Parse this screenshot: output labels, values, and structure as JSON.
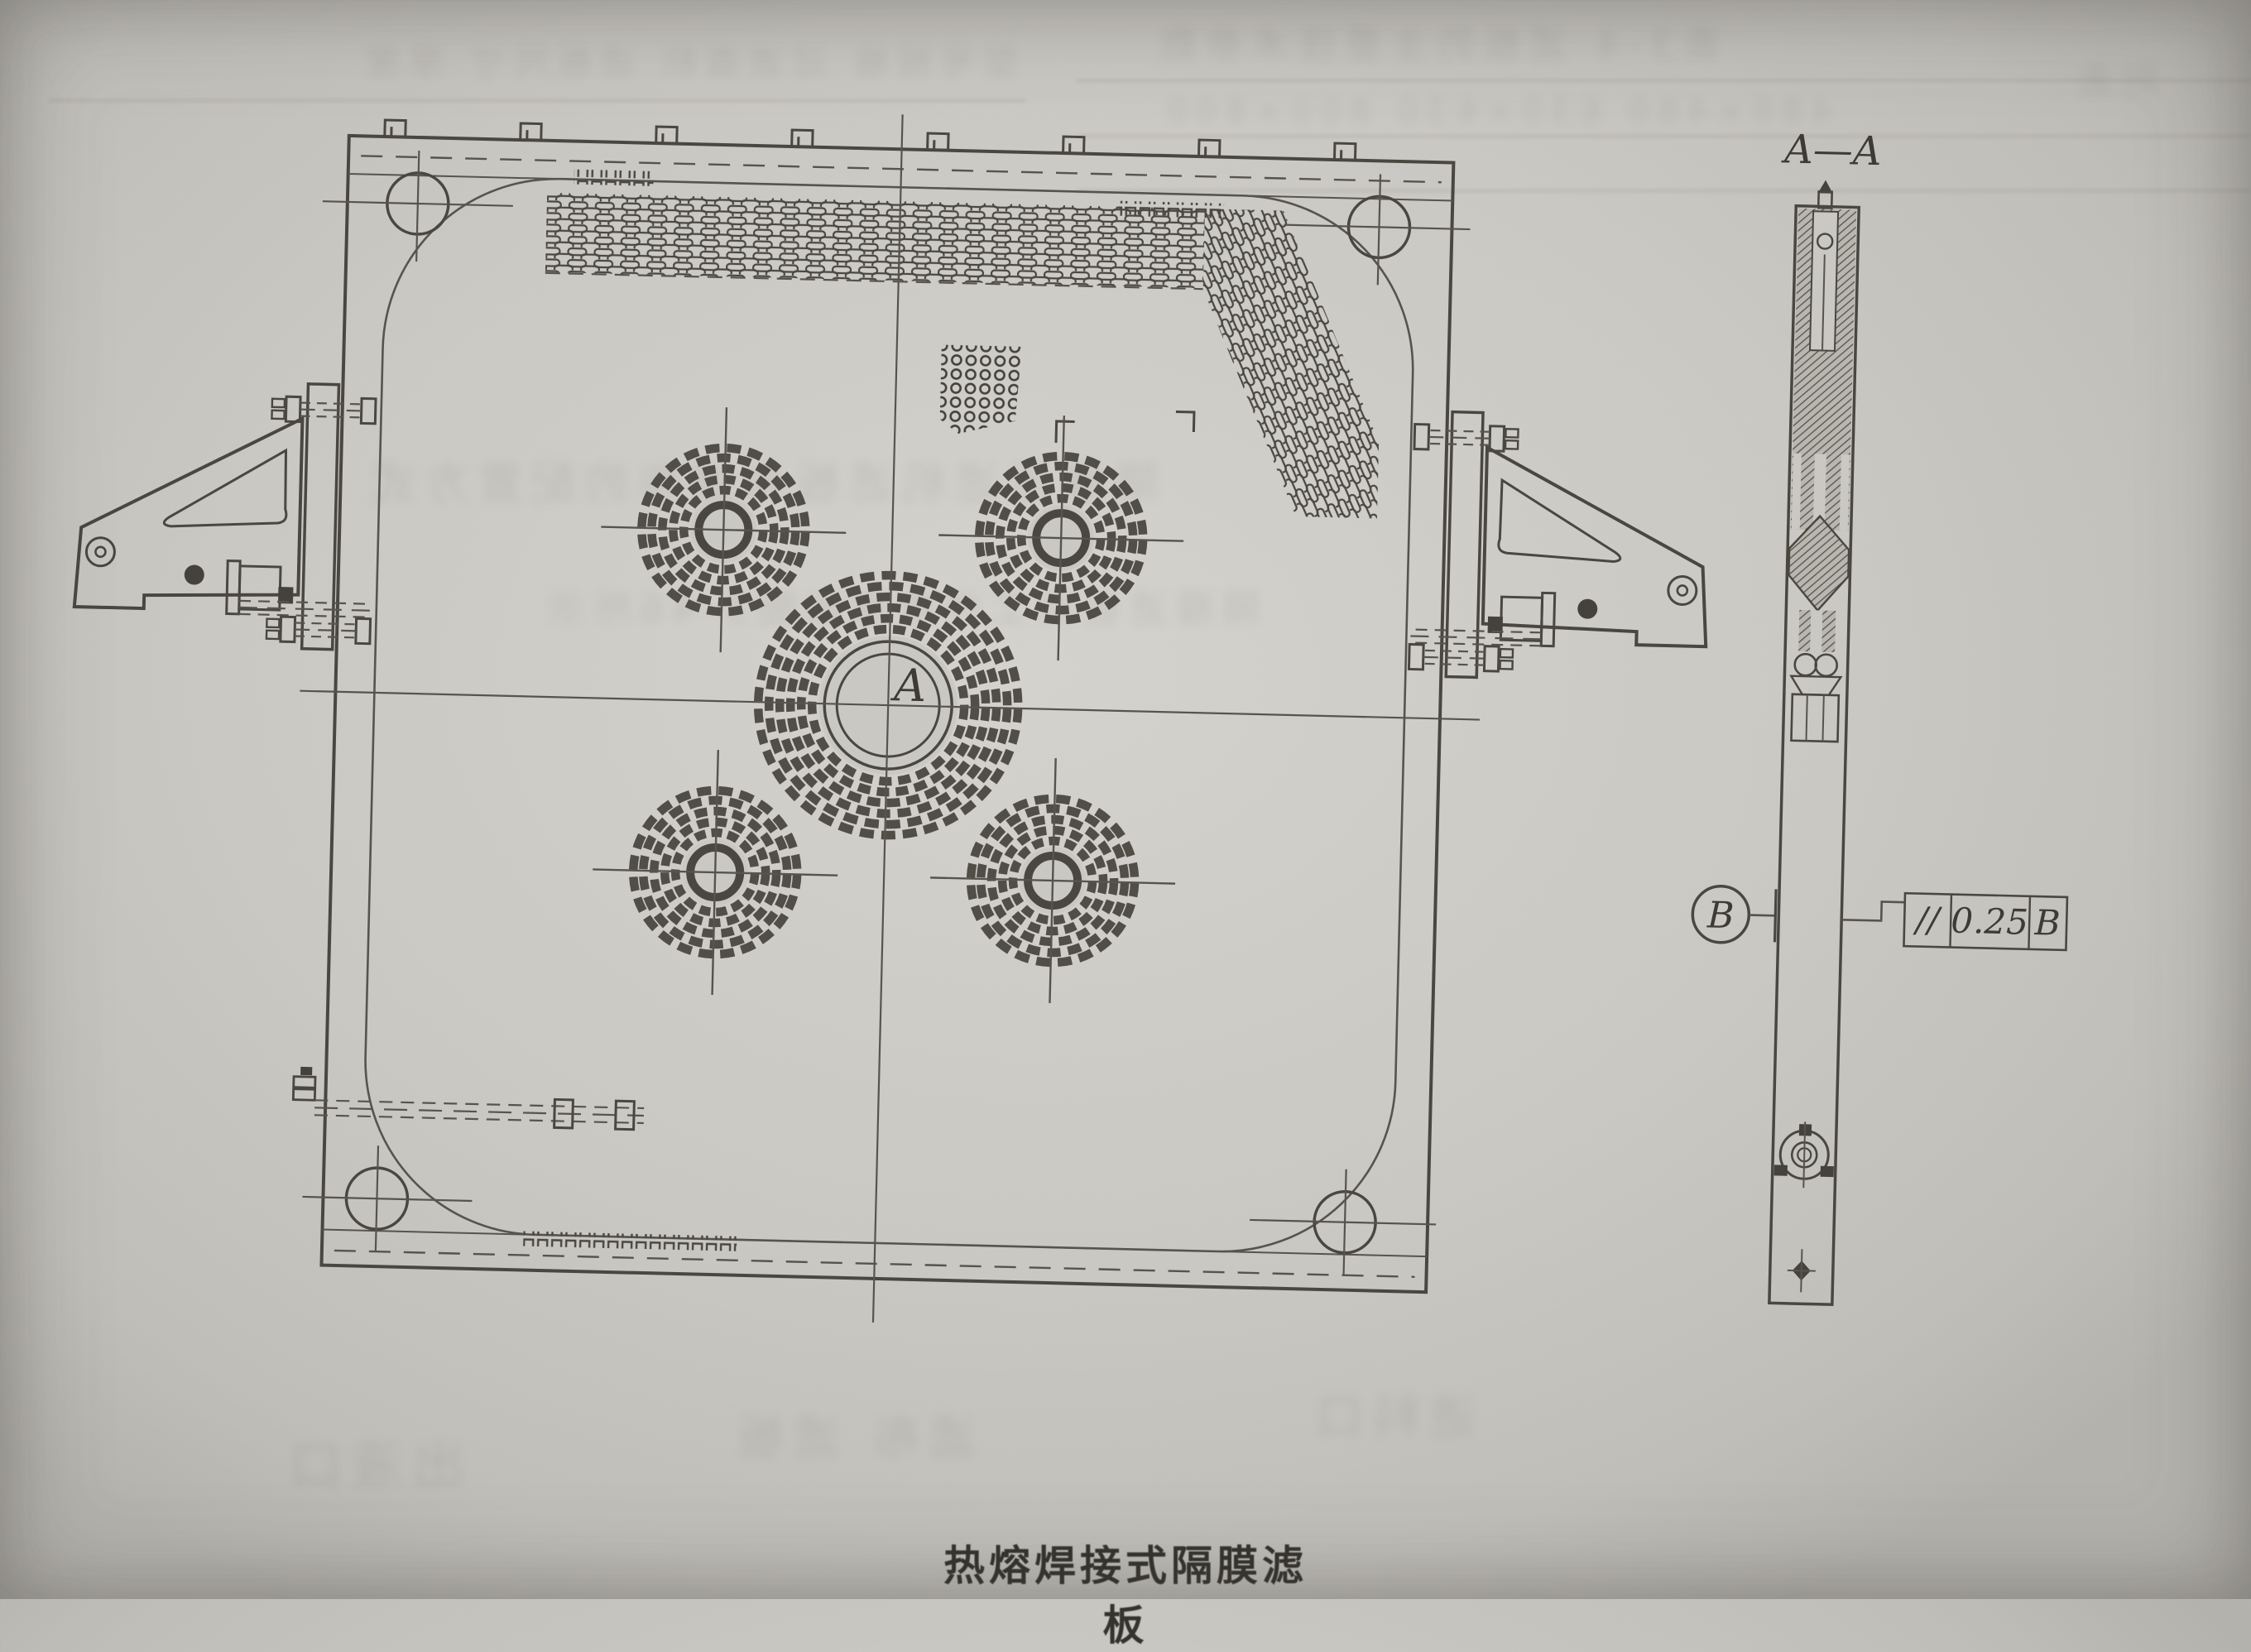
{
  "page": {
    "paper_color": "#cac8c3",
    "ink_color": "#4a4741",
    "caption": "热熔焊接式隔膜滤板"
  },
  "front_view": {
    "center_hole_label": "A"
  },
  "section_view": {
    "label": "A—A"
  },
  "datum": {
    "label": "B"
  },
  "feature_control_frame": {
    "symbol": "//",
    "tolerance": "0.25",
    "datum": "B"
  },
  "bleed_through_lines": [
    "型号规格 过滤面积 滤板尺寸 厚度",
    "表3-4 滤板的主要技术参数",
    "480×480 630×630 800×800",
    "隔膜压滤机滤板与滤布的配置方式",
    "隔膜滤板的工作原理如图3-46所示",
    "出液口",
    "滤布 滤板",
    "进料口",
    "附表"
  ]
}
